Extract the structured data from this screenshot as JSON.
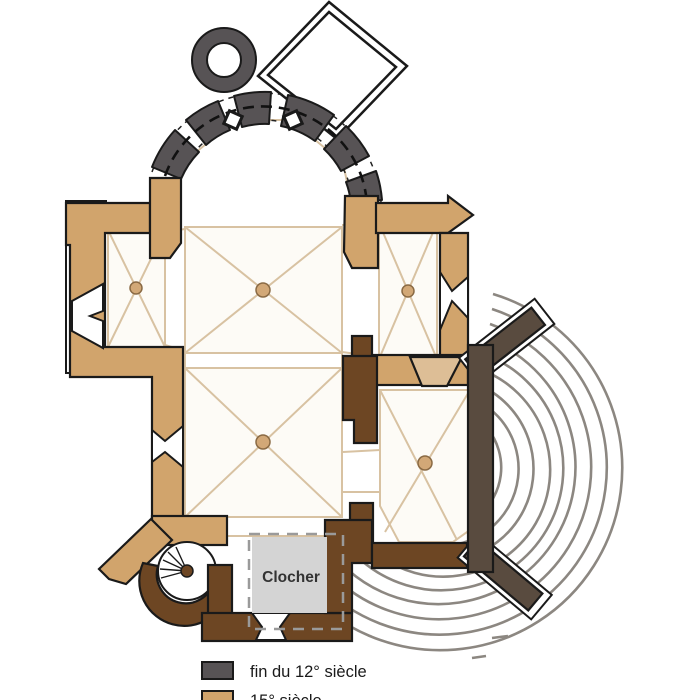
{
  "plan": {
    "tower_label": "Clocher"
  },
  "legend": {
    "items": [
      {
        "label": "fin du 12° siècle",
        "color": "#575355"
      },
      {
        "label": "15° siècle",
        "color": "#D1A46C"
      }
    ]
  },
  "colors": {
    "tan": "#D1A46C",
    "tan_light": "#DDBE96",
    "brown": "#6D4623",
    "gray12": "#575355",
    "taupe": "#594B3F",
    "arc": "#8C8781",
    "bayline": "#D8C2A2",
    "bayfill": "#FDFBF6",
    "clocher_fill": "#D4D4D4",
    "clocher_dash": "#9A9A9A",
    "outline": "#1A1A1A",
    "dot": "#D2A877"
  }
}
